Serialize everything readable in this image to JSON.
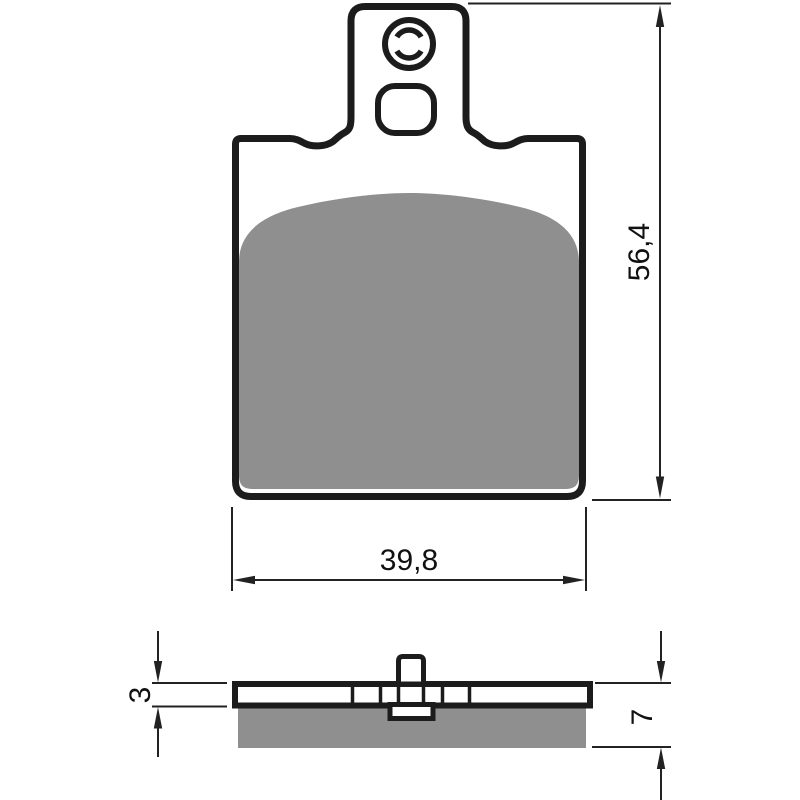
{
  "front_view": {
    "height_label": "56,4",
    "width_label": "39,8"
  },
  "side_view": {
    "backplate_thickness_label": "3",
    "total_thickness_label": "7"
  },
  "colors": {
    "outline": "#1c1c1c",
    "friction_material": "#8f8f8f",
    "dimension_line": "#222222",
    "background": "#ffffff"
  }
}
